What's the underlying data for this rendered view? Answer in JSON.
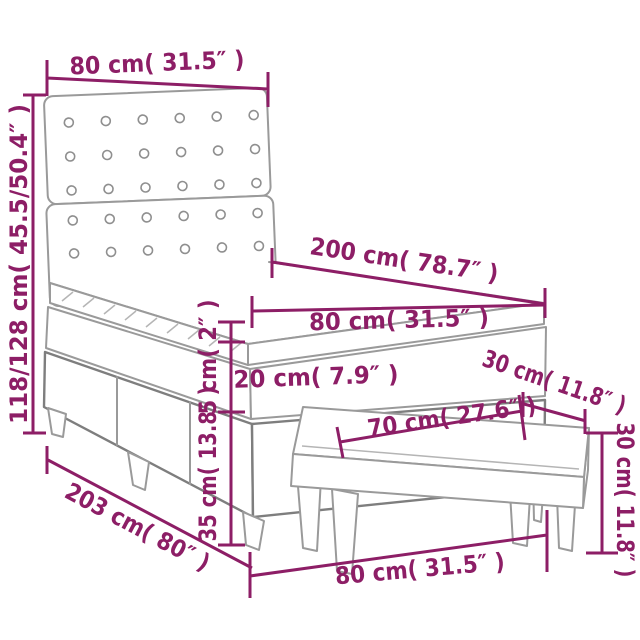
{
  "title": "Box spring bed with headboard and bench - dimension diagram",
  "colors": {
    "dimension_text": "#8D1E66",
    "furniture_outline": "#9A9A9A",
    "background": "#FFFFFF"
  },
  "labels": {
    "headboard_width": "80 cm( 31.5″ )",
    "headboard_height": "118/128 cm( 45.5/50.4″ )",
    "bed_length": "200 cm( 78.7″ )",
    "mattress_width": "80 cm( 31.5″ )",
    "topper_thickness": "5 cm( 2″ )",
    "mattress_thickness": "20 cm( 7.9″ )",
    "base_height": "35 cm( 13.8″ )",
    "total_length": "203 cm( 80″ )",
    "bench_seat_width": "70 cm( 27.6″ )",
    "bench_depth": "30 cm( 11.8″ )",
    "bench_height": "30 cm( 11.8″ )",
    "bench_width": "80 cm( 31.5″ )"
  }
}
